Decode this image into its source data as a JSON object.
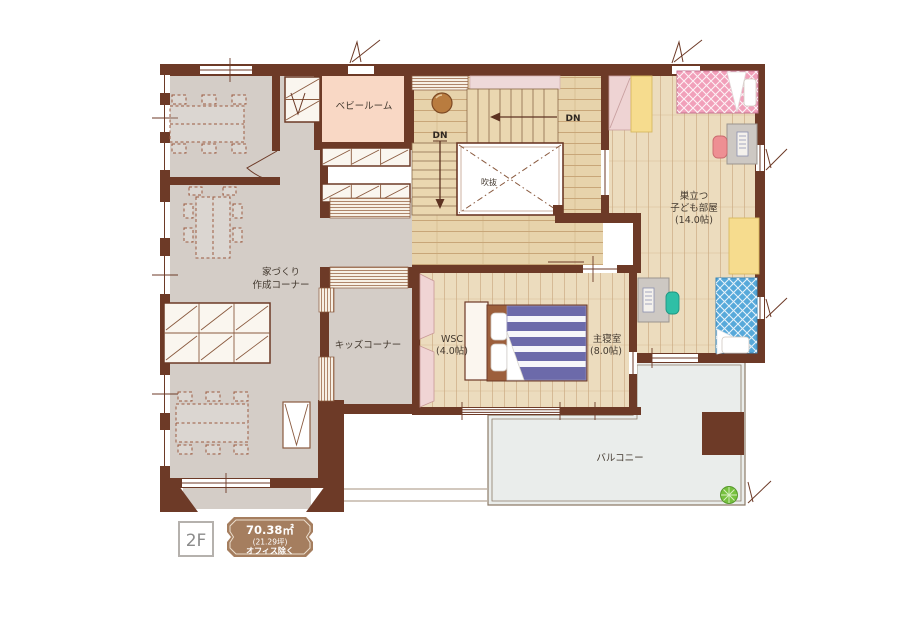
{
  "plan": {
    "floor": "2F",
    "badge": {
      "area_sqm": "70.38㎡",
      "area_tsubo": "(21.29坪)",
      "note": "オフィス除く"
    },
    "labels": {
      "baby_room": "ベビールーム",
      "office_line1": "家づくり",
      "office_line2": "作成コーナー",
      "kids_corner": "キッズコーナー",
      "wsc": "WSC",
      "wsc_size": "(4.0帖)",
      "master": "主寝室",
      "master_size": "(8.0帖)",
      "children_line1": "巣立つ",
      "children_line2": "子ども部屋",
      "children_size": "(14.0帖)",
      "balcony": "バルコニー",
      "void": "吹抜",
      "dn_top": "DN",
      "dn_left": "DN"
    },
    "colors": {
      "wall": "#6d3a27",
      "gray_floor": "#d4cdc7",
      "wood_hall": "#e7d3ab",
      "wood_room": "#ecdcbe",
      "baby_room": "#f9d8c5",
      "balcony": "#eaedeb",
      "pink_bed": "#f1a0ba",
      "blue_bed": "#57a9da",
      "purple_duvet": "#6c6aaa",
      "yellow_storage": "#f6dc8e",
      "teal_chair": "#2fbfa6",
      "pink_chair": "#ee8f93",
      "plant": "#76c13e",
      "badge": "#a57e5f"
    }
  }
}
